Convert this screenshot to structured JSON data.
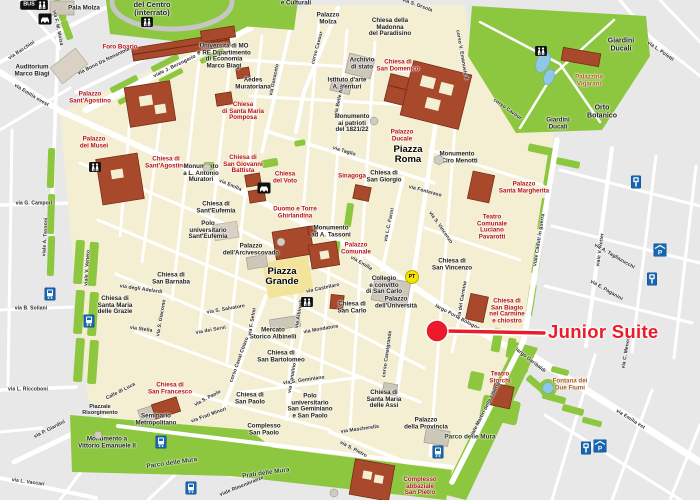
{
  "colors": {
    "land_inside": "#f4efd3",
    "land_outside": "#e8e8e8",
    "street": "#ffffff",
    "park_green": "#8dc63f",
    "building_brick": "#a7492a",
    "building_gray": "#cdc7ba",
    "water": "#8fc8e2",
    "poi_red": "#b5121b",
    "poi_brown": "#ad5a17",
    "label_black": "#1d1d1d",
    "annotation_red": "#ea1b2b",
    "icon_blue": "#1565b0",
    "icon_black": "#111111",
    "pt_yellow": "#f6e400"
  },
  "annotation": {
    "label": "Junior Suite",
    "dot": {
      "x": 437,
      "y": 331,
      "r": 11
    },
    "line": {
      "x1": 446,
      "y1": 331,
      "x2": 544,
      "y2": 333
    },
    "label_pos": {
      "x": 548,
      "y": 332
    }
  },
  "labels": [
    {
      "t": "Foro Boario",
      "x": 120,
      "y": 48,
      "k": "church"
    },
    {
      "t": "Palazzo\nSant'Agostino",
      "x": 90,
      "y": 98,
      "k": "church"
    },
    {
      "t": "Chiesa\ndi Santa Maria\nPomposa",
      "x": 243,
      "y": 112,
      "k": "church"
    },
    {
      "t": "Chiesa di\nSan Giovanni\nBattista",
      "x": 243,
      "y": 165,
      "k": "church"
    },
    {
      "t": "Chiesa\ndel Voto",
      "x": 285,
      "y": 178,
      "k": "church"
    },
    {
      "t": "Duomo e Torre\nGhirlandina",
      "x": 295,
      "y": 213,
      "k": "church"
    },
    {
      "t": "Sinagoga",
      "x": 352,
      "y": 177,
      "k": "church"
    },
    {
      "t": "Palazzo\nDucale",
      "x": 402,
      "y": 136,
      "k": "church"
    },
    {
      "t": "Chiesa di\nSan Domenico",
      "x": 398,
      "y": 66,
      "k": "church"
    },
    {
      "t": "Palazzo\nComunale",
      "x": 356,
      "y": 249,
      "k": "church"
    },
    {
      "t": "Palazzo\ndei Musei",
      "x": 94,
      "y": 143,
      "k": "church"
    },
    {
      "t": "Chiesa di\nSant'Agostino",
      "x": 166,
      "y": 163,
      "k": "church"
    },
    {
      "t": "Palazzo\nSanta Margherita",
      "x": 524,
      "y": 188,
      "k": "church"
    },
    {
      "t": "Teatro\nComunale\nLuciano\nPavarotti",
      "x": 492,
      "y": 228,
      "k": "church"
    },
    {
      "t": "Chiesa di\nSan Biagio\nnel Carmine\ne chiostro",
      "x": 507,
      "y": 312,
      "k": "church"
    },
    {
      "t": "Chiesa di\nSan Francesco",
      "x": 170,
      "y": 389,
      "k": "church"
    },
    {
      "t": "Complesso\nabbaziale\nSan Pietro",
      "x": 420,
      "y": 487,
      "k": "church"
    },
    {
      "t": "Teatro\nStorchi",
      "x": 500,
      "y": 378,
      "k": "church"
    },
    {
      "t": "Palazzina\nVigarani",
      "x": 589,
      "y": 81,
      "k": "brown"
    },
    {
      "t": "Fontana dei\nDue Fiumi",
      "x": 570,
      "y": 385,
      "k": "brown"
    },
    {
      "t": "Auditorium\nMarco Biagi",
      "x": 32,
      "y": 71,
      "k": "civic"
    },
    {
      "t": "Pala Molza",
      "x": 84,
      "y": 9,
      "k": "civic"
    },
    {
      "t": "del Centro\n(interrato)",
      "x": 152,
      "y": 9,
      "k": "civic",
      "s": 7.5
    },
    {
      "t": "Università di MO\ne RE Dipartimento\ndi Economia\nMarco Biagi",
      "x": 224,
      "y": 57,
      "k": "civic"
    },
    {
      "t": "Aedes\nMuratoriana",
      "x": 253,
      "y": 84,
      "k": "civic"
    },
    {
      "t": "Palazzo\nMolza",
      "x": 328,
      "y": 19,
      "k": "civic"
    },
    {
      "t": "e Culturali",
      "x": 296,
      "y": 4,
      "k": "civic"
    },
    {
      "t": "Chiesa della\nMadonna\ndel Paradisino",
      "x": 390,
      "y": 28,
      "k": "civic"
    },
    {
      "t": "Archivio\ndi stato",
      "x": 362,
      "y": 64,
      "k": "civic"
    },
    {
      "t": "Istituto d'arte\nA. Venturi",
      "x": 347,
      "y": 84,
      "k": "civic"
    },
    {
      "t": "Monumento\nai patrioti\ndel 1821/22",
      "x": 352,
      "y": 124,
      "k": "civic"
    },
    {
      "t": "Monumento\na Ciro Menotti",
      "x": 457,
      "y": 158,
      "k": "civic"
    },
    {
      "t": "Monumento\na L. Antonio\nMuratori",
      "x": 201,
      "y": 174,
      "k": "civic"
    },
    {
      "t": "Chiesa di\nSant'Eufemia",
      "x": 216,
      "y": 208,
      "k": "civic"
    },
    {
      "t": "Polo\nuniversitario\nSant'Eufemia",
      "x": 208,
      "y": 231,
      "k": "civic"
    },
    {
      "t": "Monumento\nad A. Tassoni",
      "x": 331,
      "y": 232,
      "k": "civic"
    },
    {
      "t": "Chiesa di\nSan Giorgio",
      "x": 384,
      "y": 177,
      "k": "civic"
    },
    {
      "t": "Chiesa di\nSan Vincenzo",
      "x": 452,
      "y": 265,
      "k": "civic"
    },
    {
      "t": "Collegio\ne convitto\ndi San Carlo",
      "x": 384,
      "y": 286,
      "k": "civic"
    },
    {
      "t": "Palazzo\ndell'Università",
      "x": 396,
      "y": 303,
      "k": "civic"
    },
    {
      "t": "Chiesa di\nSan Carlo",
      "x": 352,
      "y": 308,
      "k": "civic"
    },
    {
      "t": "Palazzo\ndell'Arcivescovado",
      "x": 251,
      "y": 250,
      "k": "civic"
    },
    {
      "t": "Chiesa di\nSan Barnaba",
      "x": 171,
      "y": 279,
      "k": "civic"
    },
    {
      "t": "Chiesa di\nSanta Maria\ndelle Grazie",
      "x": 115,
      "y": 306,
      "k": "civic"
    },
    {
      "t": "Mercato\nStorico Albinelli",
      "x": 273,
      "y": 334,
      "k": "civic"
    },
    {
      "t": "Chiesa di\nSan Bartolomeo",
      "x": 281,
      "y": 357,
      "k": "civic"
    },
    {
      "t": "Chiesa di\nSan Paolo",
      "x": 250,
      "y": 399,
      "k": "civic"
    },
    {
      "t": "Polo\nuniversitario\nSan Geminiano\ne San Paolo",
      "x": 310,
      "y": 407,
      "k": "civic"
    },
    {
      "t": "Complesso\nSan Paolo",
      "x": 264,
      "y": 430,
      "k": "civic"
    },
    {
      "t": "Chiesa di\nSanta Maria\ndelle Assi",
      "x": 384,
      "y": 400,
      "k": "civic"
    },
    {
      "t": "Palazzo\ndella Provincia",
      "x": 426,
      "y": 424,
      "k": "civic"
    },
    {
      "t": "Seminario\nMetropolitano",
      "x": 156,
      "y": 420,
      "k": "civic"
    },
    {
      "t": "Piazzale\nRisorgimento",
      "x": 100,
      "y": 411,
      "k": "civic",
      "s": 5.5
    },
    {
      "t": "Monumento a\nVittorio Emanuele II",
      "x": 107,
      "y": 443,
      "k": "civic"
    },
    {
      "t": "Giardini\nDucali",
      "x": 621,
      "y": 45,
      "k": "civic",
      "s": 7
    },
    {
      "t": "Orto\nBotanico",
      "x": 602,
      "y": 112,
      "k": "civic",
      "s": 7
    },
    {
      "t": "Giardini\nDucali",
      "x": 558,
      "y": 124,
      "k": "civic"
    },
    {
      "t": "Piazza\nRoma",
      "x": 408,
      "y": 155,
      "k": "plaza"
    },
    {
      "t": "Piazza\nGrande",
      "x": 282,
      "y": 277,
      "k": "plaza"
    },
    {
      "t": "Parco delle Mura",
      "x": 172,
      "y": 464,
      "k": "park",
      "r": -8
    },
    {
      "t": "Parco delle Mura",
      "x": 470,
      "y": 438,
      "k": "park"
    },
    {
      "t": "Prati delle Mura",
      "x": 266,
      "y": 474,
      "k": "park",
      "r": -8
    },
    {
      "t": "via F. M. Molza",
      "x": 57,
      "y": 28,
      "k": "street",
      "r": 78
    },
    {
      "t": "via Bacchini",
      "x": 22,
      "y": 51,
      "k": "street",
      "r": -33
    },
    {
      "t": "via Bono Da Nonantola",
      "x": 104,
      "y": 62,
      "k": "street",
      "r": -26
    },
    {
      "t": "viale J. Berengario",
      "x": 175,
      "y": 67,
      "k": "street",
      "r": -26
    },
    {
      "t": "via Emilia ovest",
      "x": 31,
      "y": 96,
      "k": "street",
      "r": 31
    },
    {
      "t": "via G. Campori",
      "x": 34,
      "y": 204,
      "k": "street"
    },
    {
      "t": "viale A. Tassoni",
      "x": 46,
      "y": 237,
      "k": "street",
      "r": -87
    },
    {
      "t": "viale V. Veneto",
      "x": 88,
      "y": 268,
      "k": "street",
      "r": -86
    },
    {
      "t": "via P. Giardini",
      "x": 50,
      "y": 430,
      "k": "street",
      "r": -27
    },
    {
      "t": "via L. Riccoboni",
      "x": 28,
      "y": 390,
      "k": "street"
    },
    {
      "t": "via L. Vaccari",
      "x": 28,
      "y": 483,
      "k": "street",
      "r": 8
    },
    {
      "t": "corso Cavour",
      "x": 318,
      "y": 48,
      "k": "street",
      "r": -75
    },
    {
      "t": "via Ganaceto",
      "x": 275,
      "y": 80,
      "k": "street",
      "r": -78
    },
    {
      "t": "via L.C. Farini",
      "x": 390,
      "y": 225,
      "k": "street",
      "r": -78
    },
    {
      "t": "corso Canalgrande",
      "x": 388,
      "y": 354,
      "k": "street",
      "r": -82
    },
    {
      "t": "via Canalino",
      "x": 293,
      "y": 378,
      "k": "street",
      "r": -80
    },
    {
      "t": "corso Canal Chiaro",
      "x": 240,
      "y": 360,
      "k": "street",
      "r": -70
    },
    {
      "t": "via del Carmine",
      "x": 463,
      "y": 300,
      "k": "street",
      "r": -80
    },
    {
      "t": "via Belle Arti",
      "x": 340,
      "y": 100,
      "k": "street",
      "r": -78
    },
    {
      "t": "via Albinelli",
      "x": 300,
      "y": 314,
      "k": "street",
      "r": -80
    },
    {
      "t": "via F. Selmi",
      "x": 253,
      "y": 322,
      "k": "street",
      "r": -80
    },
    {
      "t": "via S. Giacomo",
      "x": 162,
      "y": 318,
      "k": "street",
      "r": -80
    },
    {
      "t": "viale Caduti in guerra",
      "x": 540,
      "y": 240,
      "k": "street",
      "r": -81
    },
    {
      "t": "viale V. Reiter",
      "x": 601,
      "y": 250,
      "k": "street",
      "r": -82
    },
    {
      "t": "via C. Menotti",
      "x": 627,
      "y": 352,
      "k": "street",
      "r": -80
    },
    {
      "t": "viale Martiri della Libertà",
      "x": 486,
      "y": 410,
      "k": "street",
      "r": -63
    },
    {
      "t": "corso V. Emanuele II",
      "x": 461,
      "y": 55,
      "k": "street",
      "r": 80
    },
    {
      "t": "corso Cavour",
      "x": 507,
      "y": 110,
      "k": "street",
      "r": 35
    },
    {
      "t": "via L. Poletti",
      "x": 660,
      "y": 52,
      "k": "street",
      "r": 35
    },
    {
      "t": "via Taglio",
      "x": 344,
      "y": 152,
      "k": "street",
      "r": 17
    },
    {
      "t": "via Fonteraso",
      "x": 425,
      "y": 192,
      "k": "street",
      "r": 15
    },
    {
      "t": "via S. Vincenzo",
      "x": 440,
      "y": 228,
      "k": "street",
      "r": 55
    },
    {
      "t": "via Emilia",
      "x": 230,
      "y": 186,
      "k": "street",
      "r": 23
    },
    {
      "t": "via Emilia",
      "x": 361,
      "y": 264,
      "k": "street",
      "r": 30
    },
    {
      "t": "via Emilia est",
      "x": 630,
      "y": 420,
      "k": "street",
      "r": 32
    },
    {
      "t": "largo Porta Bologna",
      "x": 457,
      "y": 318,
      "k": "street",
      "r": 28
    },
    {
      "t": "largo Garibaldi",
      "x": 530,
      "y": 361,
      "k": "street",
      "r": 38
    },
    {
      "t": "via A. Tagliazucchi",
      "x": 614,
      "y": 257,
      "k": "street",
      "r": 30
    },
    {
      "t": "via E. Paganini",
      "x": 606,
      "y": 291,
      "k": "street",
      "r": 30
    },
    {
      "t": "viale Rimembranze",
      "x": 242,
      "y": 487,
      "k": "street",
      "r": -22
    },
    {
      "t": "via Frati Minori",
      "x": 209,
      "y": 416,
      "k": "street",
      "r": -20
    },
    {
      "t": "via S. Paolo",
      "x": 208,
      "y": 399,
      "k": "street",
      "r": -28
    },
    {
      "t": "Calle di Luca",
      "x": 121,
      "y": 392,
      "k": "street",
      "r": -27
    },
    {
      "t": "via degli Adelardi",
      "x": 141,
      "y": 290,
      "k": "street",
      "r": 8
    },
    {
      "t": "via B. Soliani",
      "x": 31,
      "y": 309,
      "k": "street"
    },
    {
      "t": "via Stella",
      "x": 141,
      "y": 330,
      "k": "street",
      "r": 8
    },
    {
      "t": "via S. Salvatore",
      "x": 226,
      "y": 310,
      "k": "street",
      "r": -10
    },
    {
      "t": "via dei Servi",
      "x": 211,
      "y": 331,
      "k": "street",
      "r": -10
    },
    {
      "t": "via Mondatora",
      "x": 321,
      "y": 330,
      "k": "street",
      "r": -10
    },
    {
      "t": "via Castellaro",
      "x": 323,
      "y": 289,
      "k": "street",
      "r": -12
    },
    {
      "t": "via S. Geminiano",
      "x": 304,
      "y": 381,
      "k": "street",
      "r": -8
    },
    {
      "t": "via Mascherella",
      "x": 360,
      "y": 430,
      "k": "street",
      "r": -8
    },
    {
      "t": "via S. Pietro",
      "x": 353,
      "y": 450,
      "k": "street",
      "r": 28
    },
    {
      "t": "via S. Orsola",
      "x": 417,
      "y": 6,
      "k": "street",
      "r": 20
    }
  ],
  "icons": [
    {
      "type": "bus-badge",
      "label": "BUS",
      "x": 29,
      "y": 5
    },
    {
      "type": "pedestrians",
      "x": 42,
      "y": 5
    },
    {
      "type": "car",
      "x": 45,
      "y": 19
    },
    {
      "type": "pedestrians",
      "x": 147,
      "y": 22
    },
    {
      "type": "pedestrians",
      "x": 95,
      "y": 167
    },
    {
      "type": "car",
      "x": 264,
      "y": 188
    },
    {
      "type": "pedestrians",
      "x": 307,
      "y": 302
    },
    {
      "type": "pedestrians",
      "x": 541,
      "y": 51
    },
    {
      "type": "tram-stop",
      "x": 50,
      "y": 294
    },
    {
      "type": "tram-stop",
      "x": 89,
      "y": 321
    },
    {
      "type": "tram-stop",
      "x": 161,
      "y": 442
    },
    {
      "type": "tram-stop",
      "x": 191,
      "y": 488
    },
    {
      "type": "tram-stop",
      "x": 438,
      "y": 452
    },
    {
      "type": "parking-meter",
      "x": 636,
      "y": 182
    },
    {
      "type": "covered-parking",
      "x": 660,
      "y": 250
    },
    {
      "type": "parking-meter",
      "x": 652,
      "y": 279
    },
    {
      "type": "parking-meter",
      "x": 586,
      "y": 448
    },
    {
      "type": "covered-parking",
      "x": 600,
      "y": 446
    },
    {
      "type": "pt-office",
      "label": "PT",
      "x": 412,
      "y": 277
    },
    {
      "type": "monument-hex",
      "x": 439,
      "y": 160
    },
    {
      "type": "monument",
      "x": 374,
      "y": 121
    },
    {
      "type": "monument",
      "x": 207,
      "y": 168
    },
    {
      "type": "monument",
      "x": 281,
      "y": 242
    },
    {
      "type": "monument",
      "x": 98,
      "y": 435
    },
    {
      "type": "monument",
      "x": 334,
      "y": 493
    }
  ]
}
